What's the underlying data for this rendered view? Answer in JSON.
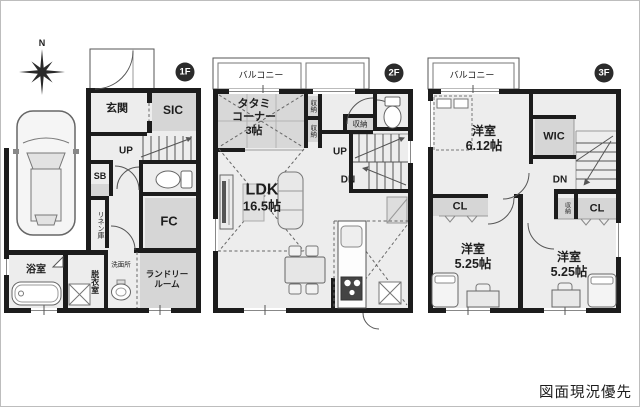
{
  "note": "図面現況優先",
  "compass": {
    "north": "N"
  },
  "floor1": {
    "badge": "1F",
    "entrance": "玄関",
    "sic": "SIC",
    "up": "UP",
    "sb": "SB",
    "linen": "リネン庫",
    "fc": "FC",
    "bathroom": "浴室",
    "dressing": "脱衣室",
    "washroom": "洗面所",
    "laundry_line1": "ランドリー",
    "laundry_line2": "ルーム"
  },
  "floor2": {
    "badge": "2F",
    "balcony": "バルコニー",
    "tatami_line1": "タタミ",
    "tatami_line2": "コーナー",
    "tatami_line3": "3帖",
    "storage": "収納",
    "up": "UP",
    "down": "DN",
    "ldk": "LDK",
    "ldk_size": "16.5帖"
  },
  "floor3": {
    "badge": "3F",
    "balcony": "バルコニー",
    "bedroom1": "洋室",
    "bedroom1_size": "6.12帖",
    "wic": "WIC",
    "down": "DN",
    "closet": "CL",
    "storage": "収納",
    "bedroom2": "洋室",
    "bedroom2_size": "5.25帖"
  }
}
